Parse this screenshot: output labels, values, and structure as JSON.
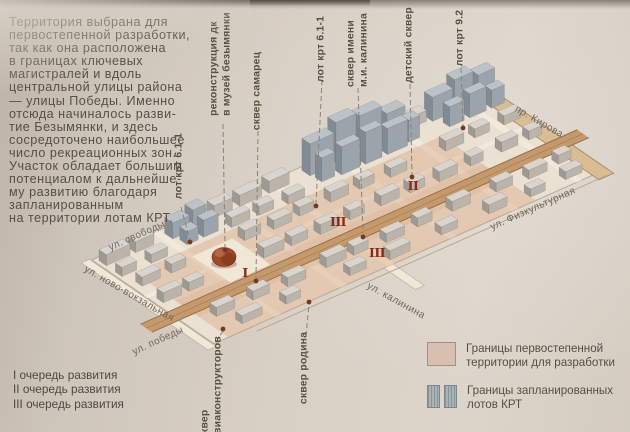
{
  "intro": {
    "text": "Территория выбрана для\nпервостепенной разработки,\nтак как она расположена\nв границах ключевых\nмагистралей и вдоль\nцентральной улицы района\n— улицы Победы. Именно\nотсюда начиналось разви-\nтие Безымянки, и здесь\nсосредоточено наибольшее\nчисло рекреационных зон.\nУчасток обладает большим\nпотенциалом к дальнейше-\nму развитию благодаря\nзапланированным\nна территории лотам КРТ."
  },
  "phases": {
    "items": [
      "I очередь развития",
      "II очередь развития",
      "III очередь развития"
    ]
  },
  "map_labels": {
    "lot_krt_611_left": "лот крт 6.1-1",
    "rekonstrukciya": "реконструкция дк\nв музей безымянки",
    "skver_samarec": "сквер самарец",
    "lot_krt_611_top": "лот крт 6.1-1",
    "skver_kalinina": "сквер имени\nм.и. калинина",
    "detskiy_skver": "детский сквер",
    "lot_krt_92": "лот крт 9.2",
    "skver_aviakonstruktorov": "сквер\nавиаконструкторов",
    "skver_rodina": "сквер родина"
  },
  "streets": {
    "svobody": "ул. свободы",
    "novo_vokzalnaya": "ул. ново-вокзальная",
    "pobedy": "ул. победы",
    "kalinina": "ул. калинина",
    "fizkulturnaya": "ул. Физкультурная",
    "kirova": "пр. Кирова"
  },
  "markers": {
    "phase1": "I",
    "phase2": "II",
    "phase3": "III"
  },
  "legend": {
    "items": [
      {
        "label": "Границы первостепенной\nтерритории для разработки",
        "color": "#d9bfb0"
      },
      {
        "label": "Границы запланированных\nлотов КРТ",
        "color": "#a9b2b8"
      }
    ]
  },
  "colors": {
    "paper": "#d6cdc2",
    "ink": "#574f45",
    "map_base": "#eae1d2",
    "block_street": "#f2ebdd",
    "road": "#c49a6c",
    "road_line": "#9a6d43",
    "pink_overlay": "#d69c76",
    "bld_top": "#d9d5ce",
    "bld_left": "#9e9992",
    "bld_right": "#bab4ab",
    "krt_top": "#bcc3c8",
    "krt_left": "#818b93",
    "krt_right": "#9ba4ab",
    "dome": "#a14a28",
    "marker_red": "#8c2817",
    "dot": "#743a1f",
    "dash_line": "#8b8276"
  }
}
